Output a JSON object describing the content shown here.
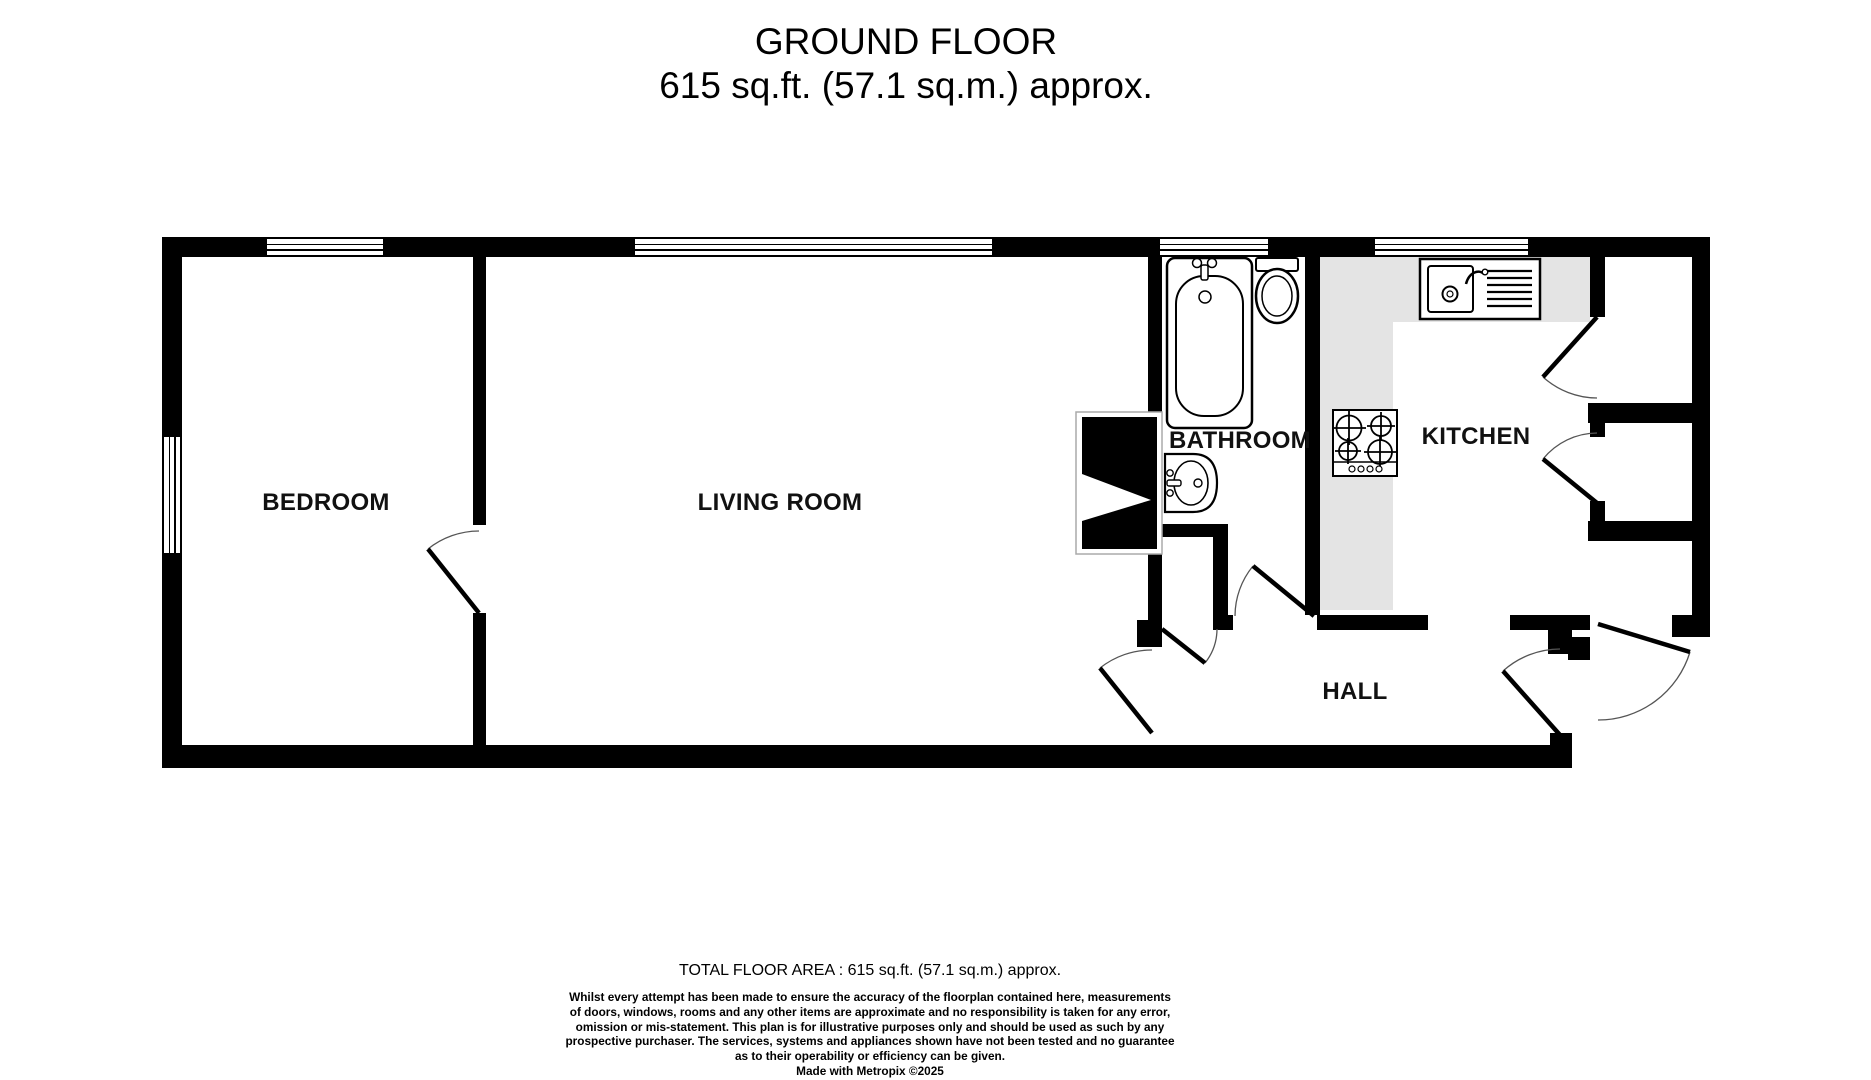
{
  "title": {
    "line1": "GROUND FLOOR",
    "line2": "615 sq.ft. (57.1 sq.m.) approx."
  },
  "room_labels": {
    "bedroom": "BEDROOM",
    "living_room": "LIVING ROOM",
    "bathroom": "BATHROOM",
    "kitchen": "KITCHEN",
    "hall": "HALL"
  },
  "fixtures": [
    "bathtub",
    "toilet",
    "basin",
    "kitchen-sink-drainer",
    "hob",
    "chimney-breast"
  ],
  "footer": {
    "total_area": "TOTAL FLOOR AREA : 615 sq.ft. (57.1 sq.m.) approx.",
    "disclaimer_lines": [
      "Whilst every attempt has been made to ensure the accuracy of the floorplan contained here, measurements",
      "of doors, windows, rooms and any other items are approximate and no responsibility is taken for any error,",
      "omission or mis-statement. This plan is for illustrative purposes only and should be used as such by any",
      "prospective purchaser. The services, systems and appliances shown have not been tested and no guarantee",
      "as to their operability or efficiency can be given."
    ],
    "credit": "Made with Metropix ©2025"
  },
  "colors": {
    "wall": "#000000",
    "counter": "#e4e4e4",
    "background": "#ffffff",
    "door_arc": "#555555"
  }
}
